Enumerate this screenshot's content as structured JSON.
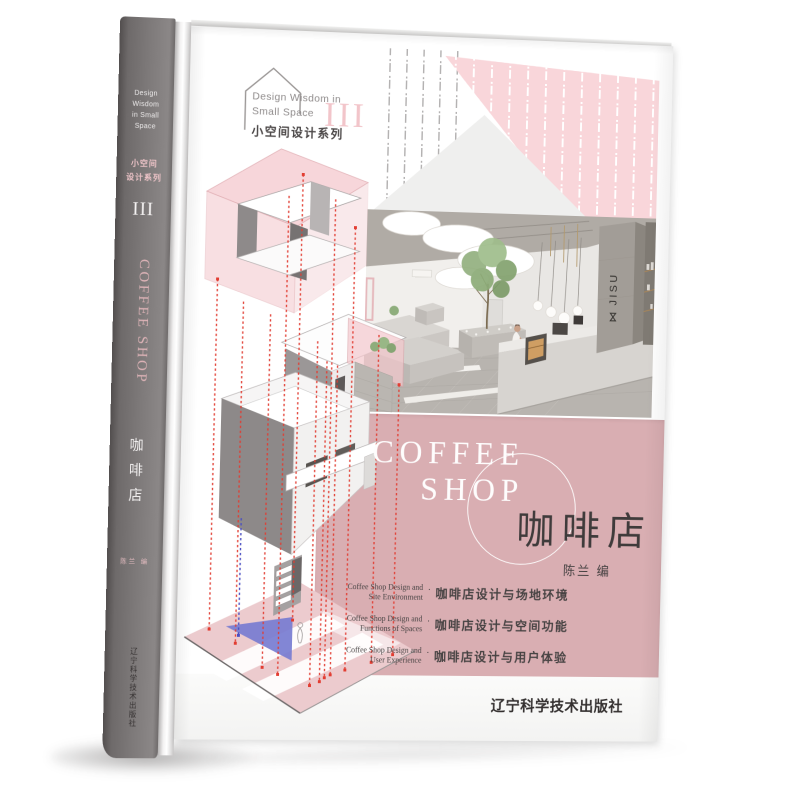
{
  "page": {
    "background": "#ffffff"
  },
  "series_logo": {
    "line1": "Design Wisdom in",
    "line2": "Small Space",
    "series_cn": "小空间设计系列",
    "volume": "III"
  },
  "cover": {
    "title_en_line1": "COFFEE",
    "title_en_line2": "SHOP",
    "title_cn": "咖啡店",
    "author": "陈兰 编",
    "separator": "·",
    "topics": [
      {
        "en_line1": "Coffee Shop Design and",
        "en_line2": "Site Environment",
        "cn": "咖啡店设计与场地环境"
      },
      {
        "en_line1": "Coffee Shop Design and",
        "en_line2": "Functions of Spaces",
        "cn": "咖啡店设计与空间功能"
      },
      {
        "en_line1": "Coffee Shop Design and",
        "en_line2": "User Experience",
        "cn": "咖啡店设计与用户体验"
      }
    ],
    "publisher": "辽宁科学技术出版社",
    "photo": {
      "sign_glyph": "⋈",
      "sign_text": "JISU"
    },
    "colors": {
      "band_pink": "#d9aeb2",
      "light_pink": "#f9d6da",
      "accent_red": "#e23d32",
      "accent_blue": "#777cd1",
      "spine_gray": "#7d7979"
    }
  },
  "spine": {
    "series_en_line1": "Design",
    "series_en_line2": "Wisdom",
    "series_en_line3": "in Small",
    "series_en_line4": "Space",
    "series_cn_line1": "小空间",
    "series_cn_line2": "设计系列",
    "volume": "III",
    "title_en": "COFFEE SHOP",
    "title_cn": "咖啡店",
    "author": "陈兰 编",
    "publisher": "辽宁科学技术出版社"
  }
}
